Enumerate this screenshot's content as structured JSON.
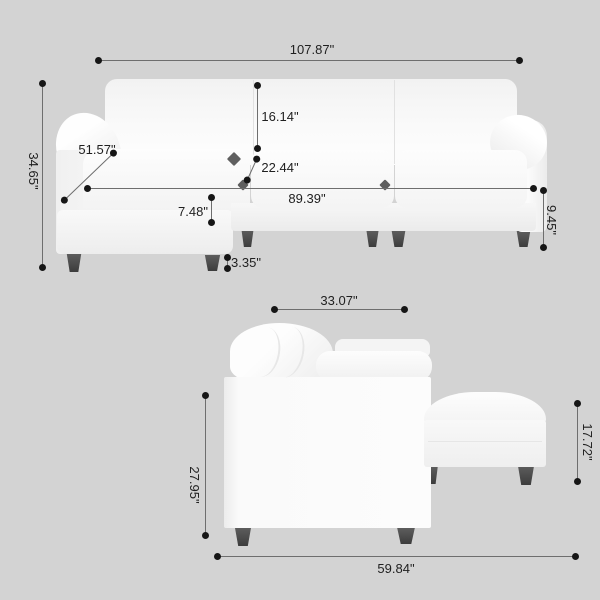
{
  "scene": {
    "background_color": "#d3d3d3",
    "dimension_line_color": "#6e6e6e",
    "dimension_dot_color": "#161616",
    "sofa_color": "#fafafa",
    "leg_color": "#4a4a4a"
  },
  "front_view": {
    "name": "sectional-sofa-front-view",
    "dims": {
      "overall_width": "107.87\"",
      "overall_height": "34.65\"",
      "chaise_length": "51.57\"",
      "back_cushion_height": "16.14\"",
      "seat_depth": "22.44\"",
      "inner_seat_width": "89.39\"",
      "seat_cushion_thickness": "7.48\"",
      "base_height": "9.45\"",
      "leg_height": "3.35\""
    }
  },
  "side_view": {
    "name": "sectional-sofa-side-view",
    "dims": {
      "top_depth": "33.07\"",
      "body_height": "27.95\"",
      "ottoman_height": "17.72\"",
      "overall_depth": "59.84\""
    }
  }
}
